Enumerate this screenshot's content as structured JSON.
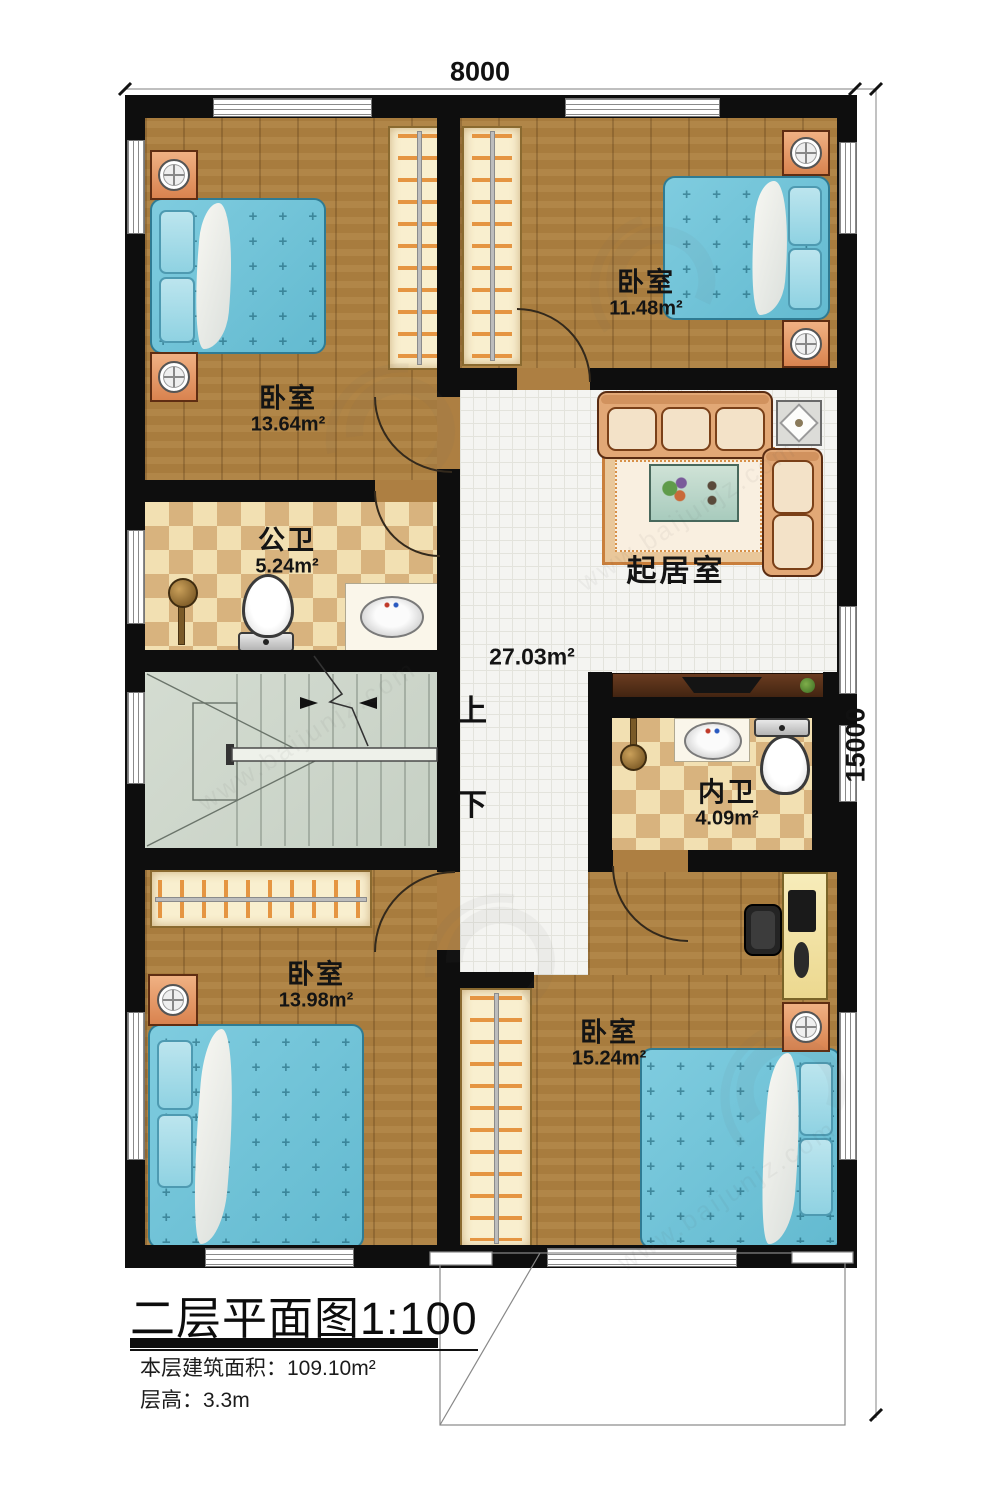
{
  "dimensions": {
    "width_label": "8000",
    "height_label": "15000"
  },
  "rooms": [
    {
      "name": "卧室",
      "area": "13.64m²"
    },
    {
      "name": "卧室",
      "area": "11.48m²"
    },
    {
      "name": "公卫",
      "area": "5.24m²"
    },
    {
      "name": "起居室",
      "area": "27.03m²"
    },
    {
      "name": "内卫",
      "area": "4.09m²"
    },
    {
      "name": "卧室",
      "area": "13.98m²"
    },
    {
      "name": "卧室",
      "area": "15.24m²"
    }
  ],
  "stairs": {
    "up_label": "上",
    "down_label": "下"
  },
  "title_block": {
    "title": "二层平面图",
    "scale": "1:100",
    "area_line": "本层建筑面积：109.10m²",
    "floor_height_line": "层高：3.3m"
  },
  "watermark": {
    "url": "www.baijunjz.com"
  },
  "colors": {
    "wall": "#0e0e0e",
    "wood_floor": "#a87c3e",
    "hall_tile": "#f4f4f1",
    "checker_light": "#f2e0b2",
    "checker_dark": "#d8b37e",
    "stairs": "#ccd6ca",
    "bed_blue": "#74c6da",
    "nightstand_orange": "#e09360",
    "wardrobe_cream": "#f9efcf",
    "sofa_tan": "#e2a876"
  }
}
